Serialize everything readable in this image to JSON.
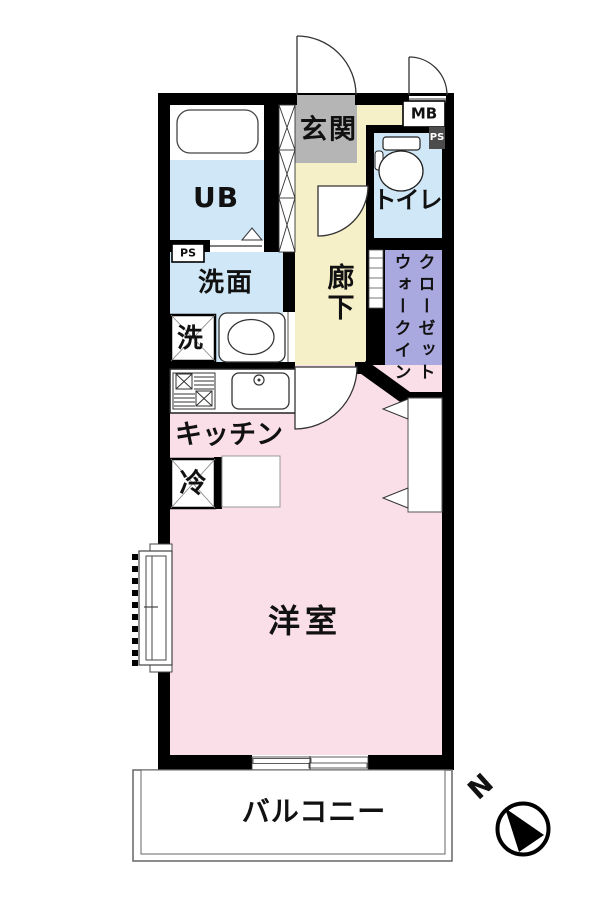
{
  "colors": {
    "wall": "#000000",
    "wet_area_blue": "#cfe7f6",
    "entrance_gray": "#b5b5b5",
    "corridor_cream": "#f6f0c8",
    "closet_purple": "#a9a9df",
    "room_pink": "#fadfe9",
    "balcony_white": "#ffffff",
    "ps_box_dark": "#4c4c4c"
  },
  "rooms": {
    "entrance": {
      "label": "玄関"
    },
    "unit_bath": {
      "label": "UB"
    },
    "toilet": {
      "label": "トイレ"
    },
    "washroom": {
      "label": "洗面"
    },
    "washing_machine": {
      "label": "洗"
    },
    "corridor": {
      "label": "廊下"
    },
    "walk_in_closet": {
      "column_right": "クローゼット",
      "column_left": "ウォークイン"
    },
    "kitchen": {
      "label": "キッチン"
    },
    "refrigerator": {
      "label": "冷"
    },
    "western_room": {
      "label": "洋室"
    },
    "balcony": {
      "label": "バルコニー"
    }
  },
  "annotations": {
    "meter_box": "MB",
    "pipe_space": "PS",
    "compass_north": "N"
  }
}
